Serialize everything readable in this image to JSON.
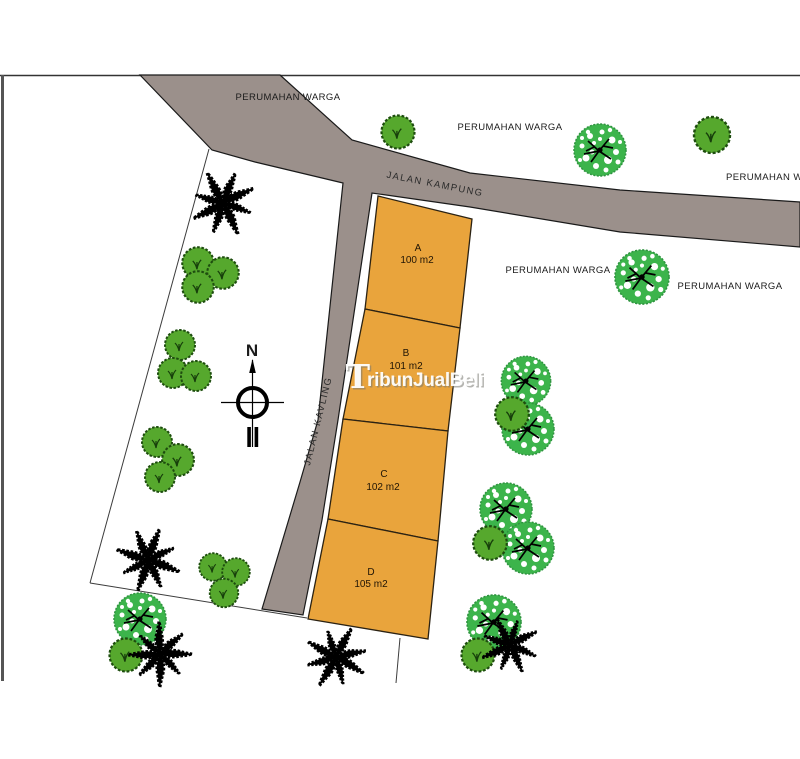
{
  "map": {
    "roads": {
      "main_road_label": "JALAN KAMPUNG",
      "side_road_label": "JALAN KAVLING"
    },
    "surroundings": {
      "labels": [
        "PERUMAHAN WARGA",
        "PERUMAHAN WARGA",
        "PERUMAHAN WARGA",
        "PERUMAHAN WARGA",
        "PERUMAHAN WARGA"
      ]
    },
    "plots": [
      {
        "name": "A",
        "area": "100 m2"
      },
      {
        "name": "B",
        "area": "101 m2"
      },
      {
        "name": "C",
        "area": "102 m2"
      },
      {
        "name": "D",
        "area": "105 m2"
      }
    ],
    "compass": {
      "north_label": "N"
    },
    "watermark": {
      "initial": "T",
      "rest": "ribunJualBeli"
    },
    "colors": {
      "road": "#9B908B",
      "plot": "#E9A43C",
      "plot_outline": "#2b2213",
      "tree_speckled": "#3CB44B",
      "bush": "#56A82D",
      "palm": "#000000"
    }
  }
}
